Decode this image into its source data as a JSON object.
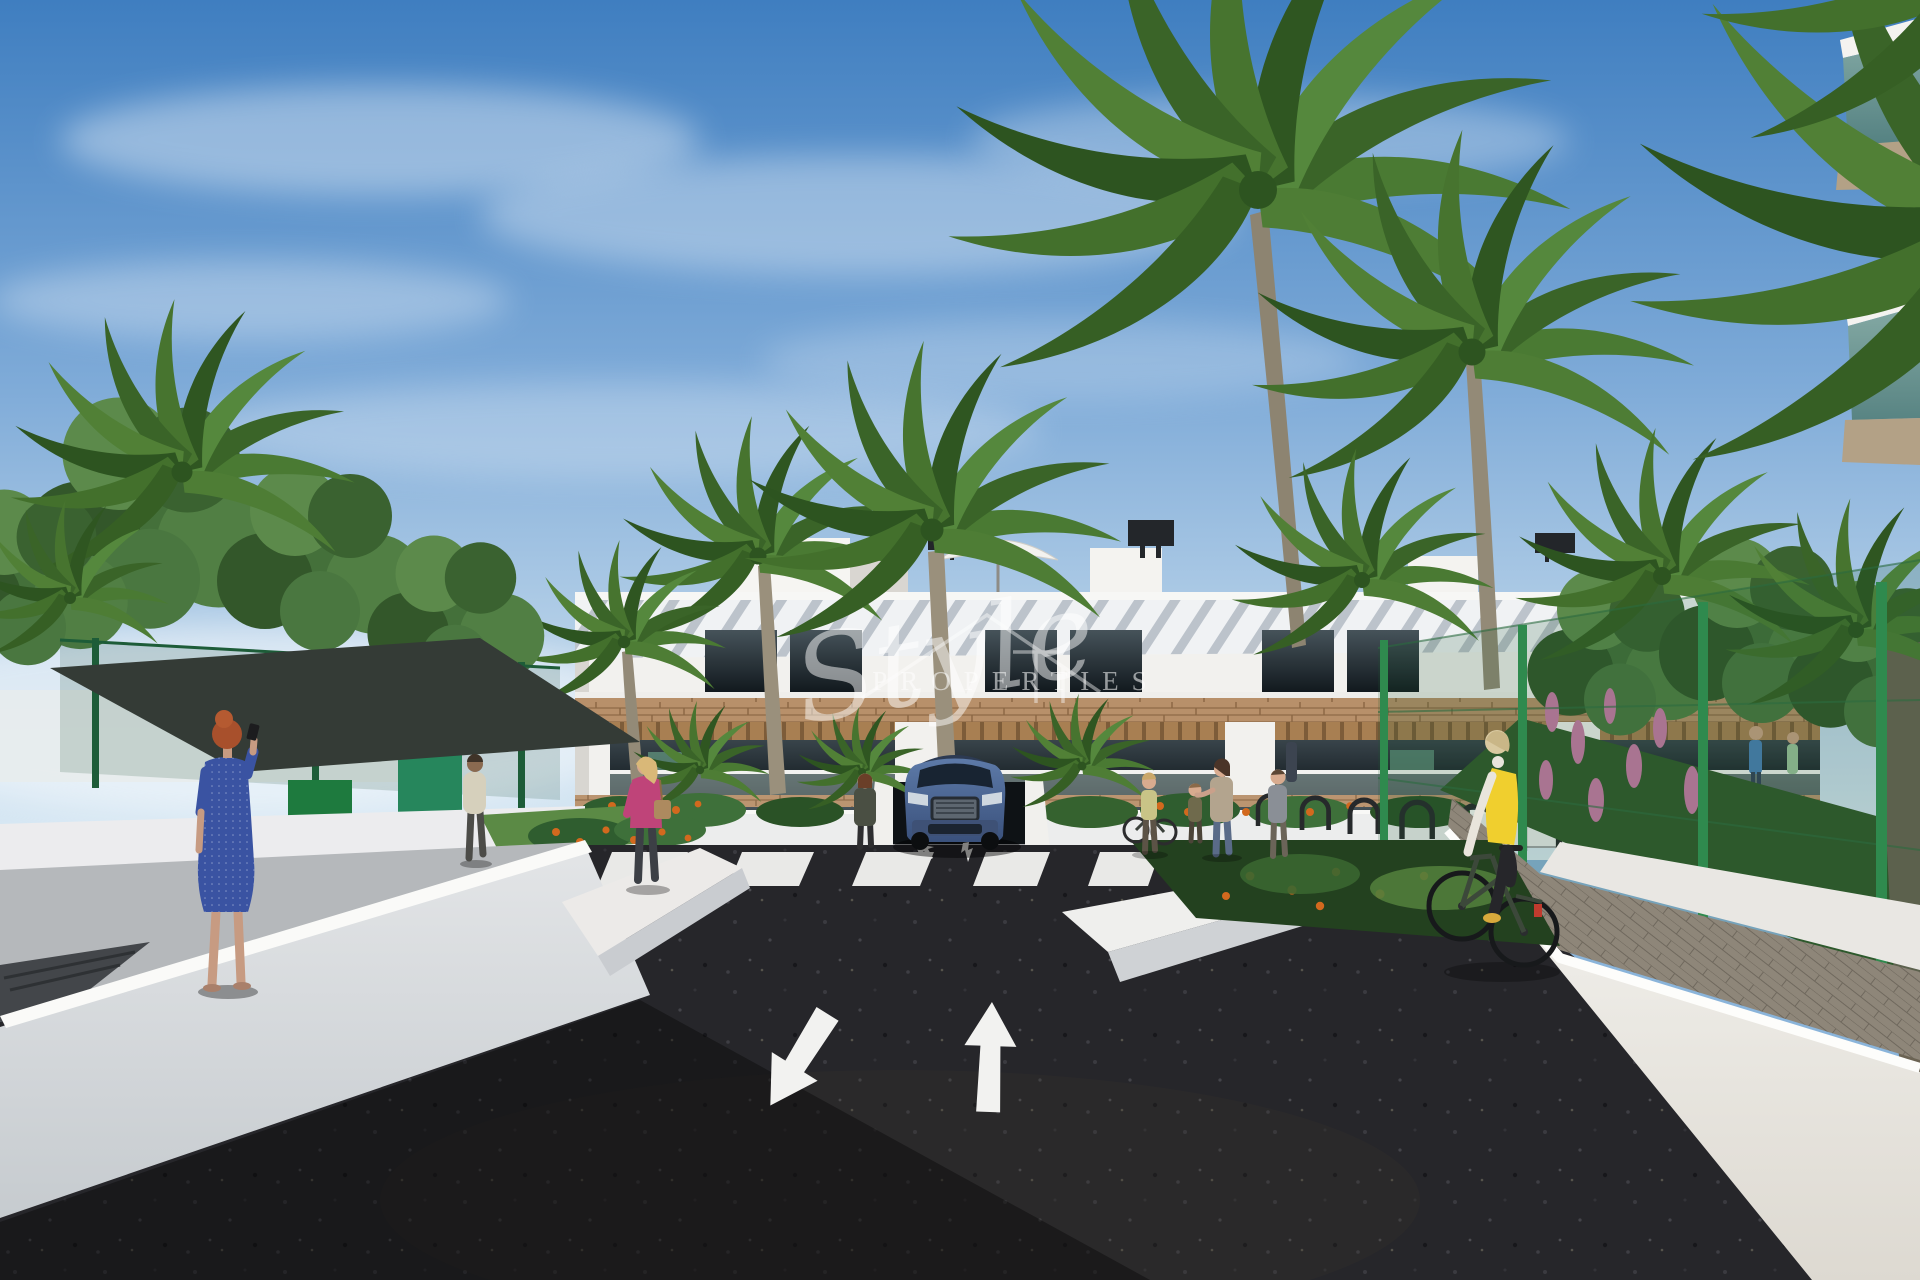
{
  "image": {
    "type": "3D architectural rendering",
    "scene": "Street entrance of a modern white Mediterranean apartment complex with wood-slat pergolas, palm trees and gardens; dark asphalt access road with painted lane arrows and zebra crossing; blue SUV exiting underground garage; pedestrians and a cyclist under a blue sky"
  },
  "watermark": {
    "script_word": "Style",
    "caps_word": "PROPERTIES",
    "symbol": "house-outline-with-flag",
    "color": "#ffffff"
  },
  "road_markings": {
    "large_arrow_left_lane": "down-left (toward viewer)",
    "large_arrow_right_lane": "up (away from viewer)",
    "small_arrows_at_garage": 2,
    "crosswalk_stripe_count": 7
  },
  "people": [
    {
      "id": "woman-on-phone",
      "description": "red-haired woman in blue dotted dress talking on phone, left walkway"
    },
    {
      "id": "man-walking-path",
      "description": "man in beige shirt walking away on left garden path"
    },
    {
      "id": "woman-pink-jacket",
      "description": "blonde woman in pink jacket with shoulder bag on left path"
    },
    {
      "id": "woman-by-garage",
      "description": "dark-dressed woman standing left of the garage entrance"
    },
    {
      "id": "woman-with-bicycle",
      "description": "woman standing with a bicycle at the bike racks"
    },
    {
      "id": "adult-with-child",
      "description": "woman patting a small child at the bike racks"
    },
    {
      "id": "woman-walking-right",
      "description": "woman walking near the right planter"
    },
    {
      "id": "cyclist",
      "description": "blonde woman in yellow vest riding a green bicycle on right paver path"
    },
    {
      "id": "balcony-couple",
      "description": "two residents standing on a first-floor terrace"
    }
  ],
  "vehicles": [
    {
      "id": "blue-suv",
      "description": "blue SUV at the underground garage ramp behind the zebra crossing"
    }
  ],
  "colors": {
    "sky_top": "#3f7ec0",
    "sky_horizon": "#dcebf5",
    "building_white": "#f2f1ee",
    "wood_cladding": "#b8906a",
    "asphalt": "#26262a",
    "wall_white": "#e8e9ea",
    "palm_green": "#4a7a33",
    "fence_green": "#2f8a4e",
    "car_blue": "#4a6a9c",
    "vest_yellow": "#f0cf2e",
    "jacket_pink": "#bf4479",
    "dress_blue": "#3a53a2",
    "flower_orange": "#d2691e",
    "flower_pink": "#c87ba6"
  }
}
